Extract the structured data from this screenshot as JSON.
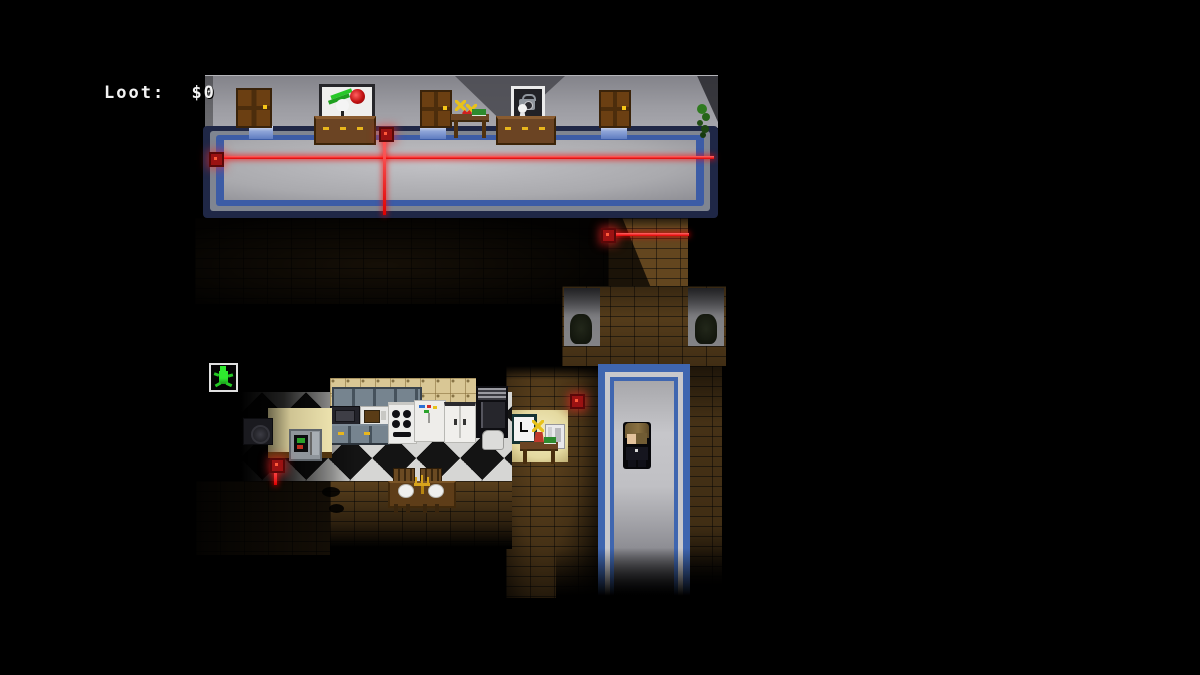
{
  "hud": {
    "loot_label": "Loot:",
    "loot_value": "$0"
  },
  "colors": {
    "background": "#000000",
    "hud_text": "#f3f3f3",
    "laser_red": "#ff1a1a",
    "trim_blue": "#3f66b0",
    "carpet_gray": "#b6b6ba",
    "wall_gray": "#9a9aa0",
    "brick_brown": "#63461f",
    "kitchen_tile": "#d9c795",
    "exit_green": "#2ee82e",
    "checker_light": "#d6d6d4",
    "checker_dark": "#141414"
  },
  "icons": {
    "exit_icon": "green running man",
    "clock_icon": "wall clock",
    "phone_icon": "wall telephone",
    "laser_device_icon": "red laser emitter",
    "statue_icon": "dark bust statue"
  }
}
